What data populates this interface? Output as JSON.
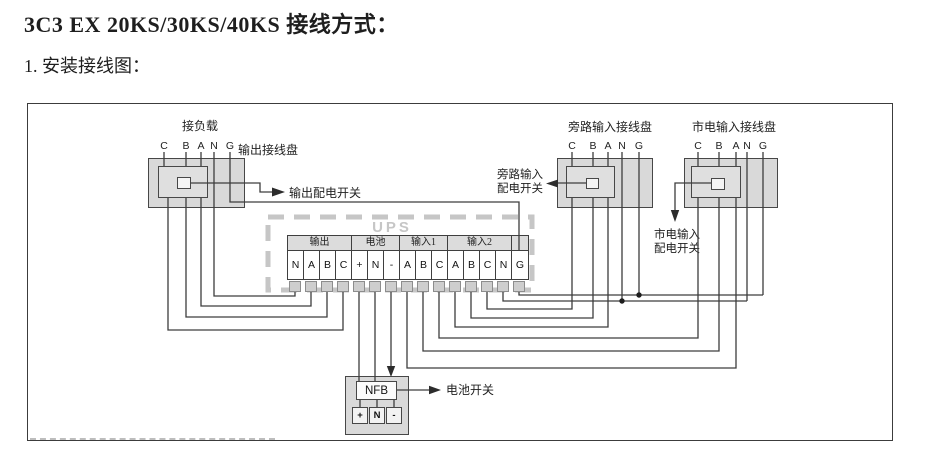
{
  "page": {
    "title": "3C3 EX 20KS/30KS/40KS 接线方式：",
    "subtitle": "1. 安装接线图："
  },
  "diagram": {
    "load_label": "接负载",
    "output_block": {
      "name": "输出接线盘",
      "terminals": [
        "C",
        "B",
        "A",
        "N",
        "G"
      ],
      "switch_label": "输出配电开关"
    },
    "bypass_block": {
      "name": "旁路输入接线盘",
      "terminals": [
        "C",
        "B",
        "A",
        "N",
        "G"
      ],
      "switch_label_line1": "旁路输入",
      "switch_label_line2": "配电开关"
    },
    "mains_block": {
      "name": "市电输入接线盘",
      "terminals": [
        "C",
        "B",
        "A",
        "N",
        "G"
      ],
      "switch_label_line1": "市电输入",
      "switch_label_line2": "配电开关"
    },
    "ups": {
      "label": "UPS",
      "groups": [
        {
          "label": "输出",
          "terminals": [
            "N",
            "A",
            "B",
            "C"
          ]
        },
        {
          "label": "电池",
          "terminals": [
            "+",
            "N",
            "-"
          ]
        },
        {
          "label": "输入1",
          "terminals": [
            "A",
            "B",
            "C"
          ]
        },
        {
          "label": "输入2",
          "terminals": [
            "A",
            "B",
            "C",
            "N"
          ]
        }
      ],
      "ground_terminal": "G"
    },
    "nfb": {
      "label": "NFB",
      "terminals": [
        "+",
        "N",
        "-"
      ],
      "switch_label": "电池开关"
    },
    "colors": {
      "box_fill": "#d9d9d9",
      "wire": "#3d3d3d",
      "ups_dash": "#c6c6c6"
    }
  }
}
